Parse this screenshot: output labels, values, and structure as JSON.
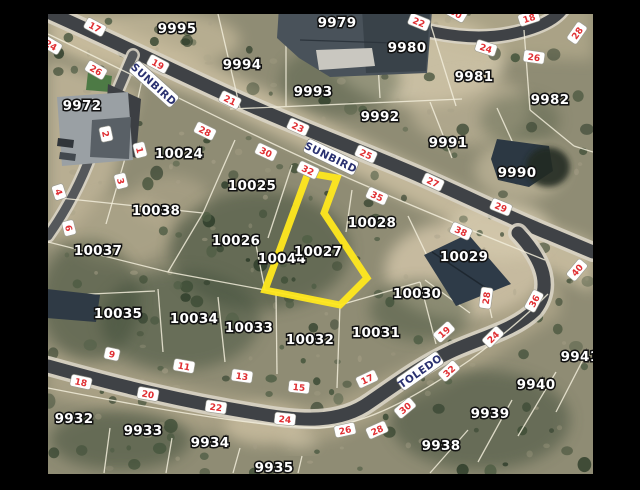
{
  "colors": {
    "frame": "#000000",
    "terrain_base": "#8f8c74",
    "road_fill": "#3f4246",
    "road_casing": "#d8d3c4",
    "boundary_line": "#f1ecd9",
    "highlight_outline": "#ffe81e",
    "number_text": "#e02f33",
    "street_text": "#2a3170",
    "lot_text": "#ffffff"
  },
  "highlighted_parcel": {
    "id": "10027"
  },
  "streets": [
    {
      "name": "SUNBIRD",
      "x": 154,
      "y": 84,
      "r": 42
    },
    {
      "name": "SUNBIRD",
      "x": 331,
      "y": 157,
      "r": 26
    },
    {
      "name": "TOLEDO",
      "x": 420,
      "y": 371,
      "r": -35
    }
  ],
  "lots": [
    {
      "id": "9995",
      "x": 177,
      "y": 33
    },
    {
      "id": "9994",
      "x": 242,
      "y": 69
    },
    {
      "id": "9979",
      "x": 337,
      "y": 27
    },
    {
      "id": "9980",
      "x": 407,
      "y": 52
    },
    {
      "id": "9981",
      "x": 474,
      "y": 81
    },
    {
      "id": "9982",
      "x": 550,
      "y": 104
    },
    {
      "id": "9993",
      "x": 313,
      "y": 96
    },
    {
      "id": "9992",
      "x": 380,
      "y": 121
    },
    {
      "id": "9991",
      "x": 448,
      "y": 147
    },
    {
      "id": "9990",
      "x": 517,
      "y": 177
    },
    {
      "id": "9972",
      "x": 82,
      "y": 110
    },
    {
      "id": "10024",
      "x": 179,
      "y": 158
    },
    {
      "id": "10025",
      "x": 252,
      "y": 190
    },
    {
      "id": "10038",
      "x": 156,
      "y": 215
    },
    {
      "id": "10026",
      "x": 236,
      "y": 245
    },
    {
      "id": "10037",
      "x": 98,
      "y": 255
    },
    {
      "id": "10044",
      "x": 282,
      "y": 263
    },
    {
      "id": "10027",
      "x": 318,
      "y": 256
    },
    {
      "id": "10028",
      "x": 372,
      "y": 227
    },
    {
      "id": "10029",
      "x": 464,
      "y": 261
    },
    {
      "id": "10030",
      "x": 417,
      "y": 298
    },
    {
      "id": "10035",
      "x": 118,
      "y": 318
    },
    {
      "id": "10034",
      "x": 194,
      "y": 323
    },
    {
      "id": "10033",
      "x": 249,
      "y": 332
    },
    {
      "id": "10032",
      "x": 310,
      "y": 344
    },
    {
      "id": "10031",
      "x": 376,
      "y": 337
    },
    {
      "id": "9932",
      "x": 74,
      "y": 423
    },
    {
      "id": "9933",
      "x": 143,
      "y": 435
    },
    {
      "id": "9934",
      "x": 210,
      "y": 447
    },
    {
      "id": "9935",
      "x": 274,
      "y": 472
    },
    {
      "id": "9938",
      "x": 441,
      "y": 450
    },
    {
      "id": "9939",
      "x": 490,
      "y": 418
    },
    {
      "id": "9940",
      "x": 536,
      "y": 389
    },
    {
      "id": "9941",
      "x": 580,
      "y": 361
    }
  ],
  "road_numbers": [
    {
      "n": "17",
      "x": 95,
      "y": 27,
      "r": 28
    },
    {
      "n": "19",
      "x": 158,
      "y": 64,
      "r": 28
    },
    {
      "n": "21",
      "x": 230,
      "y": 100,
      "r": 26
    },
    {
      "n": "23",
      "x": 298,
      "y": 127,
      "r": 24
    },
    {
      "n": "25",
      "x": 366,
      "y": 154,
      "r": 24
    },
    {
      "n": "27",
      "x": 433,
      "y": 182,
      "r": 25
    },
    {
      "n": "29",
      "x": 501,
      "y": 207,
      "r": 22
    },
    {
      "n": "24",
      "x": 51,
      "y": 45,
      "r": 30
    },
    {
      "n": "26",
      "x": 96,
      "y": 70,
      "r": 30
    },
    {
      "n": "28",
      "x": 205,
      "y": 131,
      "r": 26
    },
    {
      "n": "30",
      "x": 266,
      "y": 152,
      "r": 25
    },
    {
      "n": "32",
      "x": 308,
      "y": 170,
      "r": 25
    },
    {
      "n": "35",
      "x": 377,
      "y": 196,
      "r": 24
    },
    {
      "n": "38",
      "x": 461,
      "y": 231,
      "r": 24
    },
    {
      "n": "40",
      "x": 577,
      "y": 270,
      "r": -50
    },
    {
      "n": "36",
      "x": 534,
      "y": 301,
      "r": -62
    },
    {
      "n": "28",
      "x": 486,
      "y": 298,
      "r": -82
    },
    {
      "n": "2",
      "x": 106,
      "y": 134,
      "r": 78
    },
    {
      "n": "1",
      "x": 140,
      "y": 150,
      "r": 76
    },
    {
      "n": "3",
      "x": 121,
      "y": 181,
      "r": 76
    },
    {
      "n": "4",
      "x": 59,
      "y": 192,
      "r": 72
    },
    {
      "n": "6",
      "x": 69,
      "y": 228,
      "r": 76
    },
    {
      "n": "22",
      "x": 419,
      "y": 22,
      "r": 22
    },
    {
      "n": "30",
      "x": 456,
      "y": 13,
      "r": 30
    },
    {
      "n": "24",
      "x": 486,
      "y": 48,
      "r": 18
    },
    {
      "n": "26",
      "x": 534,
      "y": 57,
      "r": 8
    },
    {
      "n": "18",
      "x": 529,
      "y": 18,
      "r": -18
    },
    {
      "n": "28",
      "x": 577,
      "y": 33,
      "r": -55
    },
    {
      "n": "9",
      "x": 112,
      "y": 354,
      "r": 12
    },
    {
      "n": "11",
      "x": 184,
      "y": 366,
      "r": 10
    },
    {
      "n": "13",
      "x": 242,
      "y": 376,
      "r": 8
    },
    {
      "n": "15",
      "x": 299,
      "y": 387,
      "r": 6
    },
    {
      "n": "17",
      "x": 367,
      "y": 379,
      "r": -25
    },
    {
      "n": "19",
      "x": 444,
      "y": 332,
      "r": -42
    },
    {
      "n": "24",
      "x": 493,
      "y": 337,
      "r": -45
    },
    {
      "n": "18",
      "x": 81,
      "y": 382,
      "r": 12
    },
    {
      "n": "20",
      "x": 148,
      "y": 394,
      "r": 10
    },
    {
      "n": "22",
      "x": 216,
      "y": 407,
      "r": 8
    },
    {
      "n": "24",
      "x": 285,
      "y": 419,
      "r": 6
    },
    {
      "n": "26",
      "x": 345,
      "y": 430,
      "r": -12
    },
    {
      "n": "28",
      "x": 377,
      "y": 430,
      "r": -24
    },
    {
      "n": "30",
      "x": 405,
      "y": 408,
      "r": -40
    },
    {
      "n": "32",
      "x": 449,
      "y": 371,
      "r": -42
    }
  ]
}
